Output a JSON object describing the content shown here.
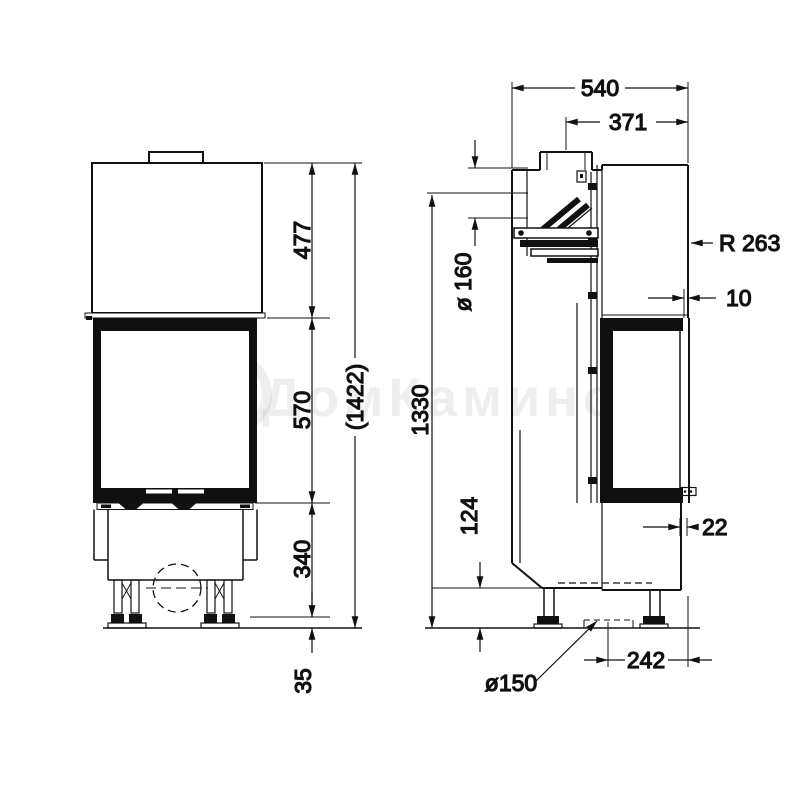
{
  "watermark": {
    "text": "ДомКаминов"
  },
  "dimensions": {
    "front": {
      "top_section": "477",
      "window_height": "570",
      "base_height": "340",
      "feet_height": "35",
      "total_height": "(1422)"
    },
    "side": {
      "depth": "540",
      "flue_offset": "371",
      "flue_pipe_diameter": "ø 160",
      "rear_outlet_height": "1330",
      "plinth_height": "124",
      "front_radius": "R 263",
      "top_gap": "10",
      "door_gap": "22",
      "air_intake_offset": "242",
      "air_intake_diameter": "ø150"
    }
  }
}
